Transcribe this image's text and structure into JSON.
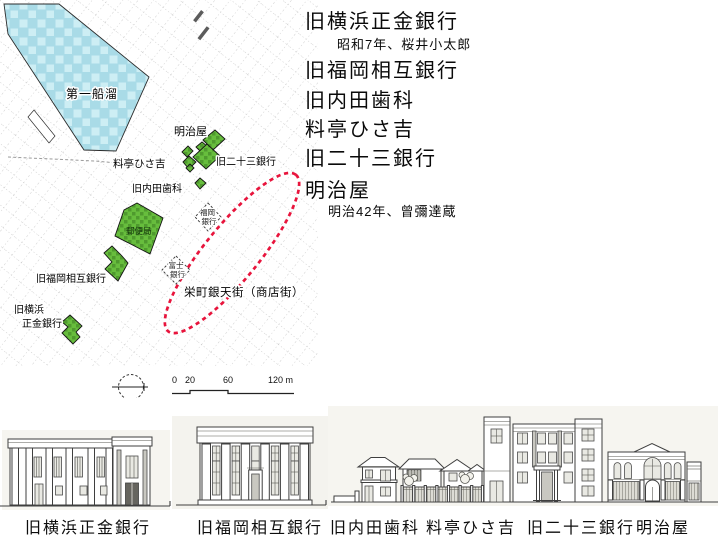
{
  "legend": {
    "items": [
      {
        "name": "旧横浜正金銀行",
        "detail": "昭和7年、桜井小太郎"
      },
      {
        "name": "旧福岡相互銀行"
      },
      {
        "name": "旧内田歯科"
      },
      {
        "name": "料亭ひさ吉"
      },
      {
        "name": "旧二十三銀行"
      },
      {
        "name": "明治屋",
        "detail": "明治42年、曾彌達蔵"
      }
    ]
  },
  "map": {
    "water_label": "第一船溜",
    "labels": {
      "meijiya": "明治屋",
      "nijusan_bank": "旧二十三銀行",
      "ryotei": "料亭ひさ吉",
      "uchida": "旧内田歯科",
      "post_office": "郵便局",
      "fukuoka_sogo": "旧福岡相互銀行",
      "yokohama_l1": "旧横浜",
      "yokohama_l2": "正金銀行",
      "fukuoka_bank_l1": "福岡",
      "fukuoka_bank_l2": "銀行",
      "fuji_bank_l1": "富士",
      "fuji_bank_l2": "銀行",
      "shopping_street": "栄町銀天街（商店街）"
    },
    "scale": {
      "t0": "0",
      "t1": "20",
      "t2": "60",
      "t3": "120 m"
    }
  },
  "elevations": {
    "labels": [
      "旧横浜正金銀行",
      "旧福岡相互銀行",
      "旧内田歯科",
      "料亭ひさ吉",
      "旧二十三銀行",
      "明治屋"
    ]
  },
  "colors": {
    "water": "#a9dbe7",
    "water_light": "#cdeef4",
    "building_green": "#67bd3d",
    "building_green_dark": "#4f9a2e",
    "highlight_red": "#e8143c",
    "street_gray": "#b8b8b8"
  }
}
